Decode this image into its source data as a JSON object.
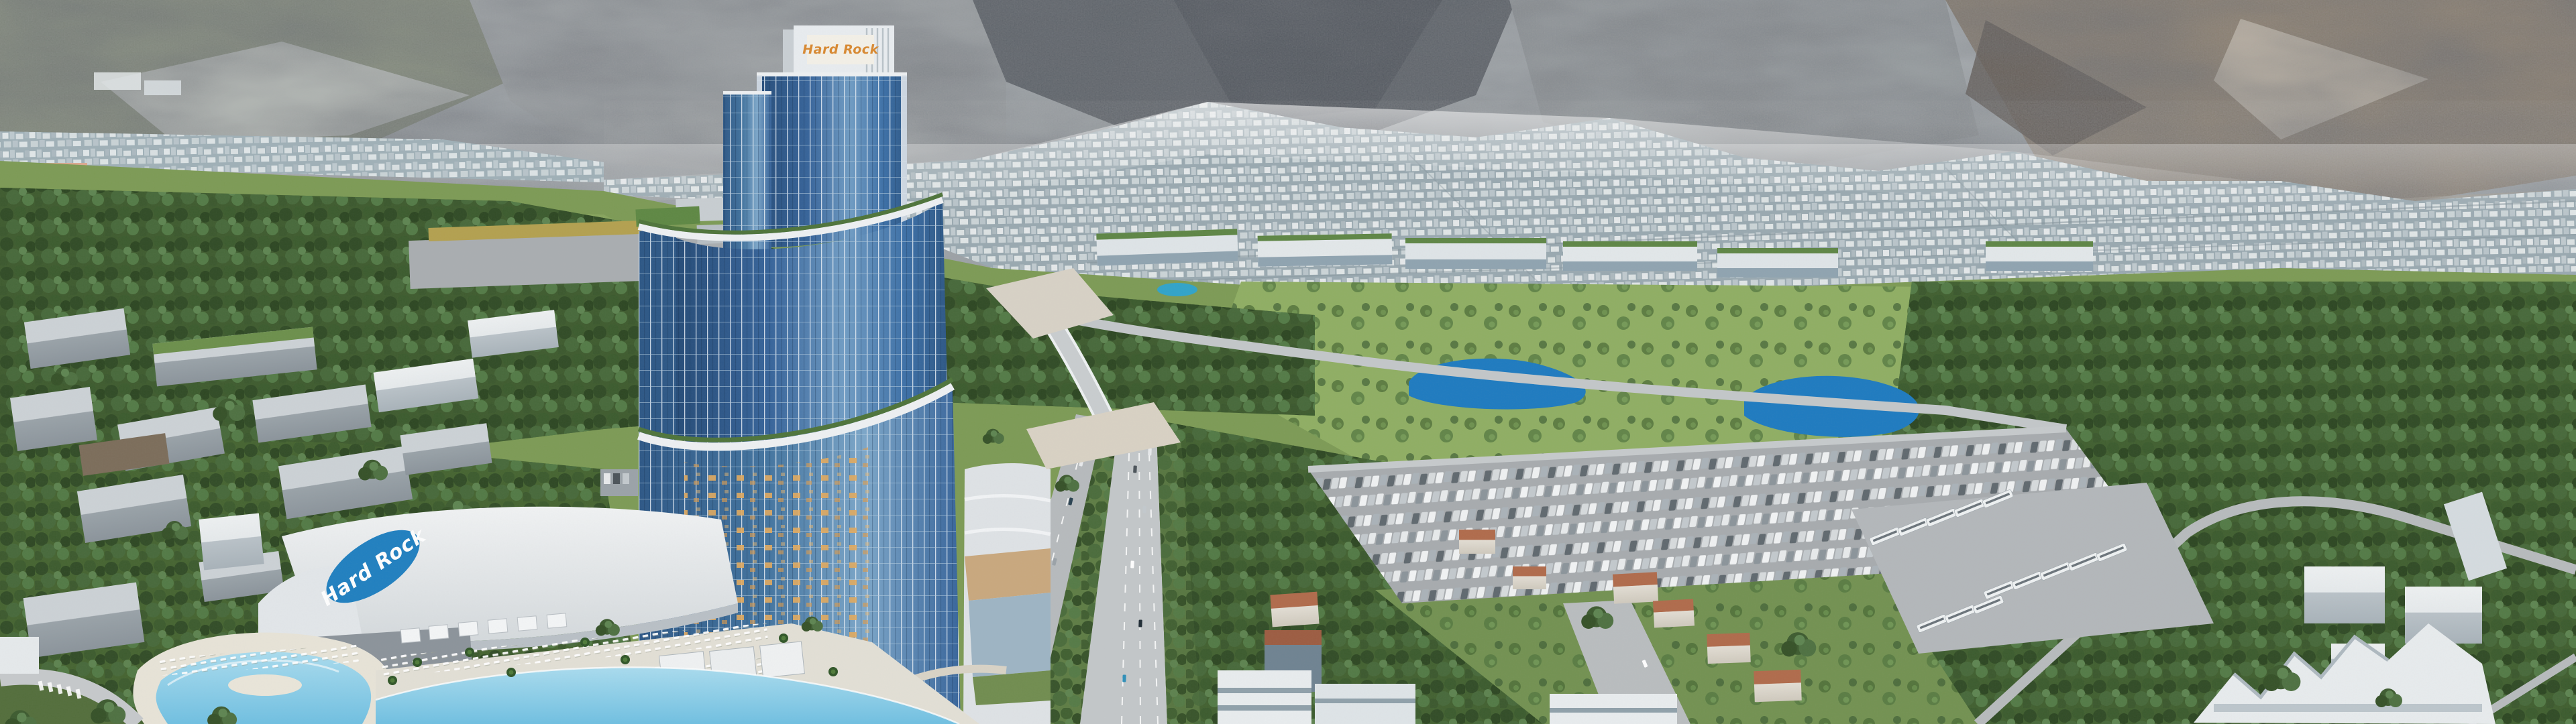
{
  "scene": {
    "branding": {
      "tower_sign": "Hard Rock",
      "roof_logo": "Hard Rock"
    },
    "palette": {
      "logo_orange": "#d9882f",
      "logo_blue": "#1e7fc0",
      "glass_blue": "#35639a",
      "glass_deep": "#234a77",
      "lake_blue": "#1c7ac0",
      "pond_cyan": "#2fa3c9",
      "pool_blue": "#8fd0e8",
      "lawn_green": "#8fae62",
      "forest_green": "#3d5a2d",
      "mountain_gray": "#9aa0a5",
      "mountain_brown": "#857867",
      "city_gray": "#c3ced3",
      "road_gray": "#b9bdc0",
      "roof_white": "#eef0f1",
      "terracotta": "#b06a4a",
      "sand_deck": "#e6dfc9"
    }
  }
}
